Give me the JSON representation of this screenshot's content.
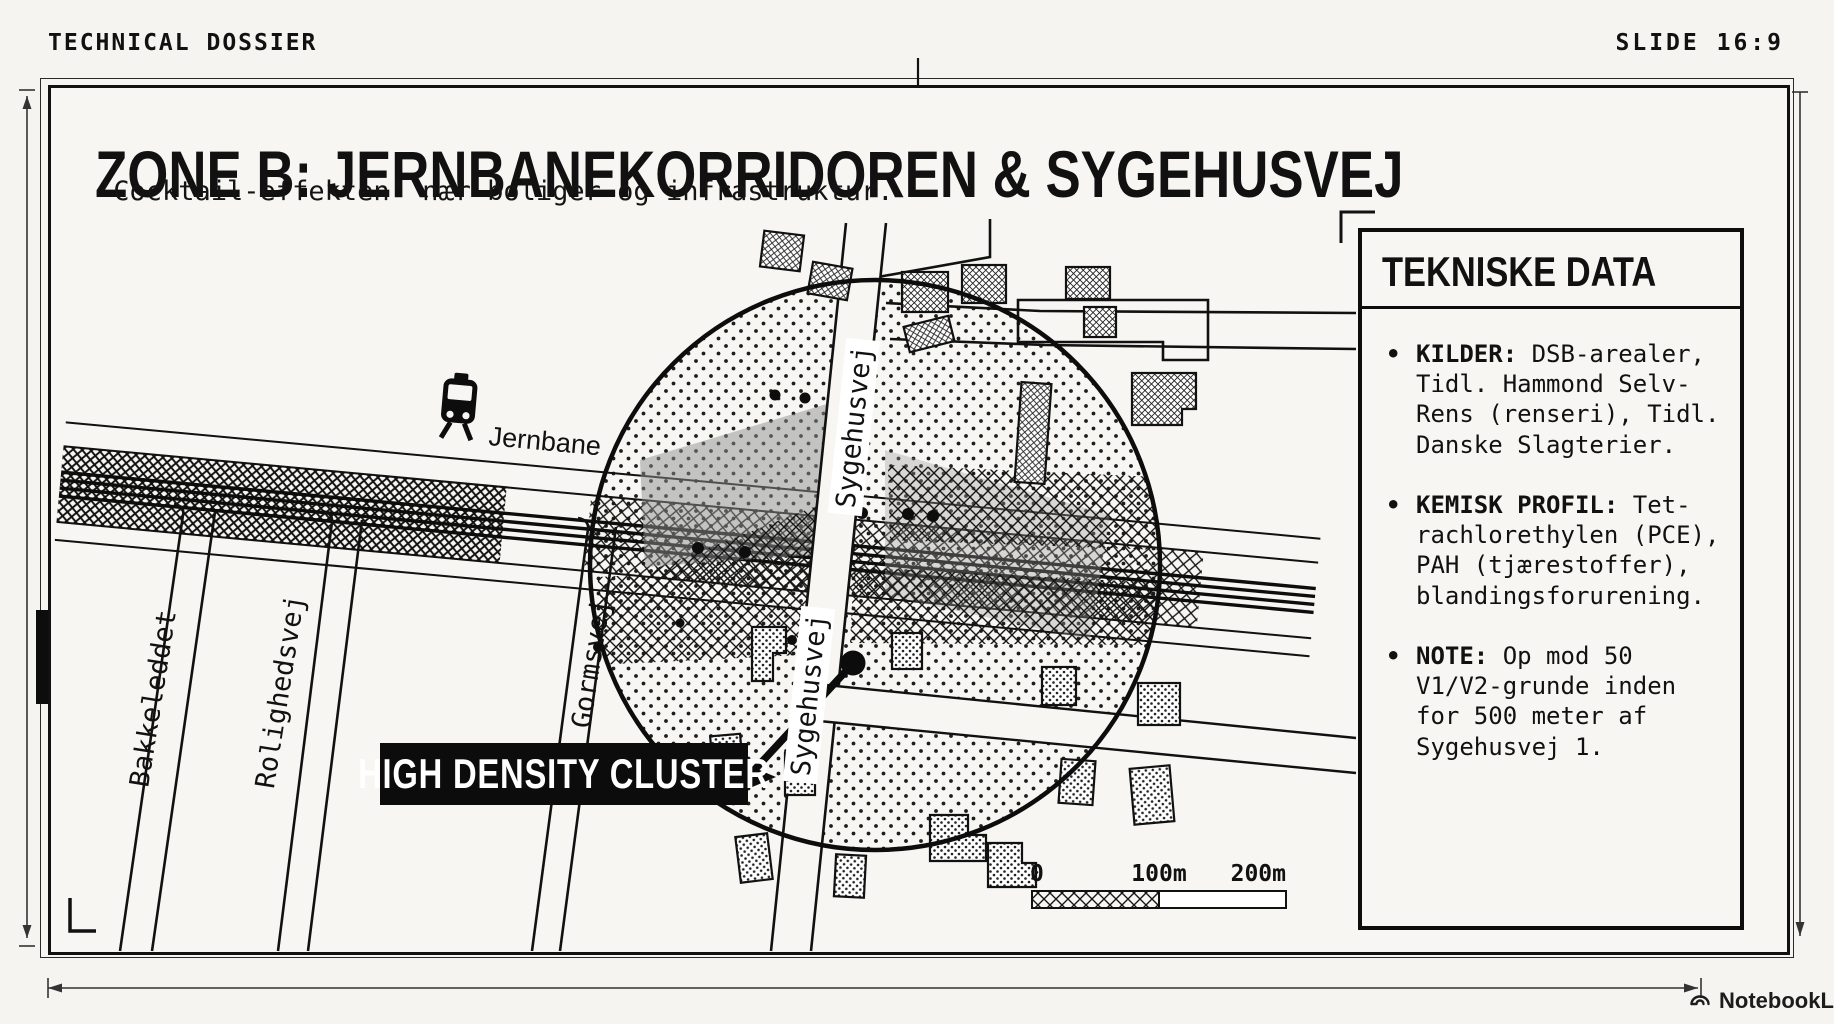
{
  "header": {
    "left": "TECHNICAL DOSSIER",
    "right": "SLIDE 16:9"
  },
  "title": "ZONE B: JERNBANEKORRIDOREN & SYGEHUSVEJ",
  "subtitle": "'Cocktail-effekten' nær boliger og infrastruktur.",
  "map": {
    "railway_label": "Jernbane",
    "streets": [
      "Bakkeleddet",
      "Rolighedsvej",
      "Gormsvej",
      "Sygehusvej",
      "Sygehusvej"
    ],
    "cluster_label": "HIGH DENSITY CLUSTER",
    "scale": {
      "start": "0",
      "mid": "100m",
      "end": "200m"
    }
  },
  "panel": {
    "title": "TEKNISKE DATA",
    "bullet": "•",
    "items": [
      {
        "label": "KILDER:",
        "text": " DSB-arealer, Tidl. Hammond Selv-Rens (renseri), Tidl. Danske Slagterier."
      },
      {
        "label": "KEMISK PROFIL:",
        "text": " Tet-rachlorethylen (PCE), PAH (tjærestoffer), blandingsforurening."
      },
      {
        "label": "NOTE:",
        "text": " Op mod 50 V1/V2-grunde inden for 500 meter af Sygehusvej 1."
      }
    ]
  },
  "footer": {
    "brand": "NotebookLM"
  },
  "colors": {
    "ink": "#111111",
    "paper": "#f7f6f2"
  }
}
